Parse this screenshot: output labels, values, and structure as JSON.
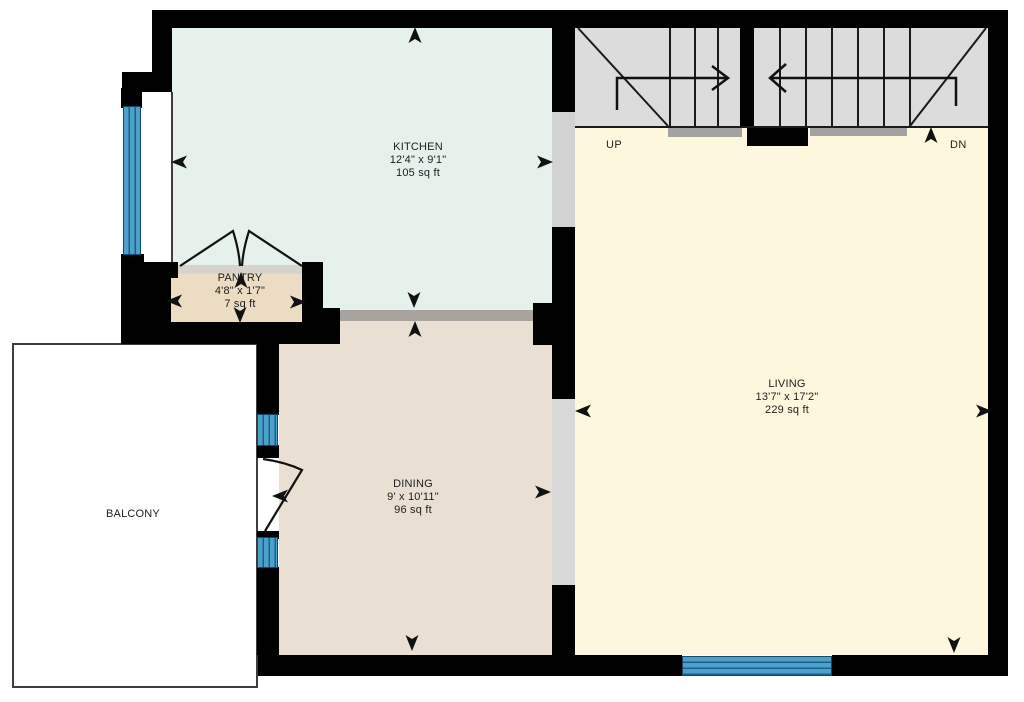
{
  "rooms": {
    "kitchen": {
      "name": "KITCHEN",
      "dimensions": "12'4\" x 9'1\"",
      "area": "105 sq ft"
    },
    "pantry": {
      "name": "PANTRY",
      "dimensions": "4'8\" x 1'7\"",
      "area": "7 sq ft"
    },
    "dining": {
      "name": "DINING",
      "dimensions": "9' x 10'11\"",
      "area": "96 sq ft"
    },
    "living": {
      "name": "LIVING",
      "dimensions": "13'7\" x 17'2\"",
      "area": "229 sq ft"
    },
    "balcony": {
      "name": "BALCONY"
    }
  },
  "stairs": {
    "up_label": "UP",
    "down_label": "DN"
  },
  "colors": {
    "kitchen": "#e6f1ec",
    "pantry": "#ebdcc3",
    "dining": "#e9dfd2",
    "living": "#fdf8dd",
    "stairs": "#dcdcdc",
    "opening_gray": "#a7a49f",
    "light_opening_gray": "#d4d2cf",
    "window_blue": "#4da0c8",
    "wall_black": "#000000",
    "balcony_border": "#3d3d3d"
  }
}
